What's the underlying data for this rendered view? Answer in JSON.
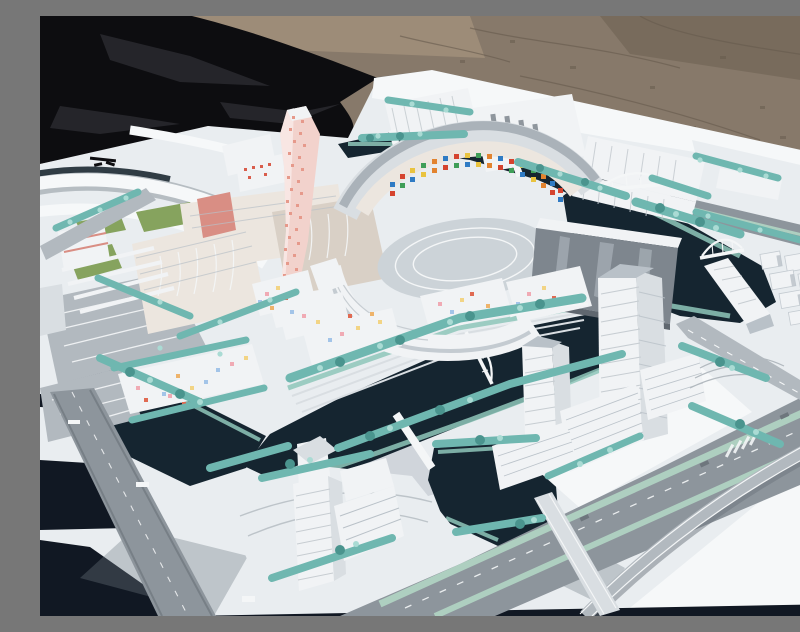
{
  "meta": {
    "alt": "Outdoor photograph of a white architectural scale model of a waterfront urban district: a twisting pink-dotted tower, a circular courtyard complex with colorful mosaic facades, white high-rise towers, dark canals with arched bridges, teal model trees, gray boulevards and a black tarp with gravel ground behind the model"
  },
  "scene": {
    "background": [
      "gravel-ground",
      "black-tarp"
    ],
    "landmarks": [
      "model-base-board",
      "pink-twisting-tower",
      "circular-courtyard-complex",
      "mosaic-inner-facade",
      "gray-glass-slab",
      "top-row-ribbed-slabs",
      "left-cream-complex",
      "colorful-dotted-lowrises",
      "east-highrise-cluster",
      "southwest-tower-island",
      "canal-network",
      "arch-bridges",
      "tree-lined-boulevard",
      "flyover-ramp",
      "parking-lots",
      "rail-symbol-road-marks"
    ]
  },
  "palette": {
    "gravel": "#87796a",
    "gravelLight": "#a3917c",
    "gravelDark": "#655a4c",
    "tarp": "#0d0d10",
    "tarpFold": "#28282d",
    "baseWhite": "#e9edf0",
    "baseBright": "#f6f8f9",
    "tableDark": "#111823",
    "shadow": "#6f7a85",
    "road": "#8d959c",
    "roadLight": "#b2b9bf",
    "roadDark": "#6e767d",
    "laneWhite": "#f4f6f7",
    "water": "#152530",
    "waterDeep": "#0f1c26",
    "bank": "#8fc7ba",
    "tree": "#6fb7b0",
    "treeLight": "#aadbd4",
    "treeDark": "#4a948e",
    "lawn": "#86a35e",
    "bldgWhite": "#f1f3f5",
    "bldgFace": "#d9dee2",
    "bldgShadow": "#b9c1c8",
    "ribLine": "#c7cdd2",
    "glassGray": "#7e868e",
    "glassLight": "#aab2b9",
    "glassDark": "#5f676f",
    "cream": "#ece6df",
    "creamShade": "#d9d0c6",
    "pinkWall": "#d98e84",
    "pinkTower": "#f2d2cc",
    "pinkDot": "#e6998b",
    "courtyard": "#ccd3d8",
    "bridgeWhite": "#f4f6f7",
    "median": "#aecfc0",
    "mosaicRed": "#d5442f",
    "mosaicBlue": "#2f7bc4",
    "mosaicYellow": "#e9c33f",
    "mosaicGreen": "#3f9e58",
    "mosaicOrange": "#e2832f",
    "pastelPink": "#f0aab4",
    "pastelYellow": "#f2d485",
    "pastelBlue": "#a3c4e8",
    "pastelRed": "#e06a52",
    "pastelOrange": "#eeb36b"
  }
}
